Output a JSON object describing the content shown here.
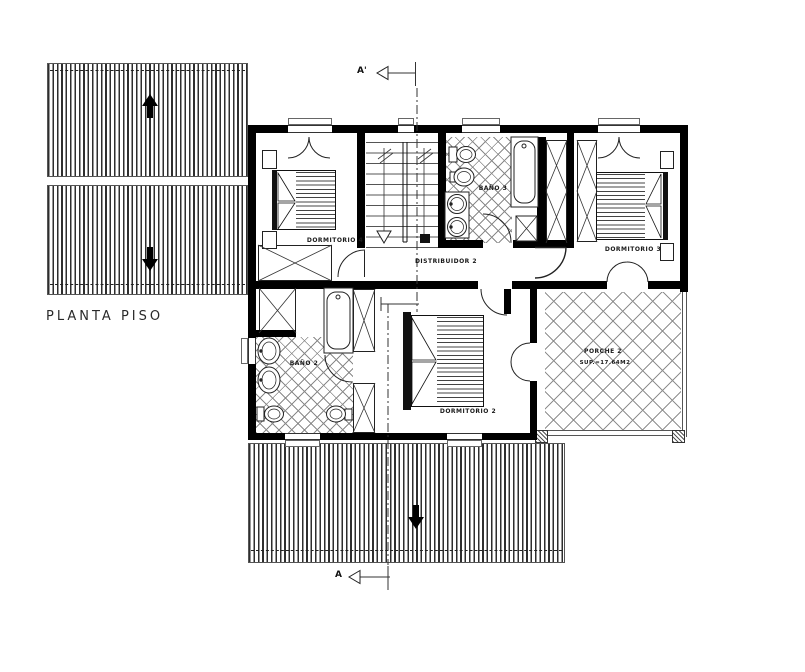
{
  "title": {
    "label": "PLANTA PISO"
  },
  "rooms": {
    "dormitorio_4": {
      "label": "DORMITORIO 4"
    },
    "bano_3": {
      "label": "BAÑO 3"
    },
    "dormitorio_3": {
      "label": "DORMITORIO 3"
    },
    "distribuidor_2": {
      "label": "DISTRIBUIDOR 2"
    },
    "bano_2": {
      "label": "BAÑO 2"
    },
    "dormitorio_2": {
      "label": "DORMITORIO 2"
    },
    "porche_2": {
      "label": "PORCHE 2",
      "area": "SUP.=17.64M2"
    }
  },
  "section": {
    "top_label": "A'",
    "bottom_label": "A"
  },
  "icons": {
    "roof_arrows": "slope-direction-arrows",
    "section_arrows": "section-cut-arrows"
  },
  "colors": {
    "wall": "#000000",
    "line": "#222222",
    "hatch": "#8a8a8a",
    "paper": "#ffffff"
  }
}
